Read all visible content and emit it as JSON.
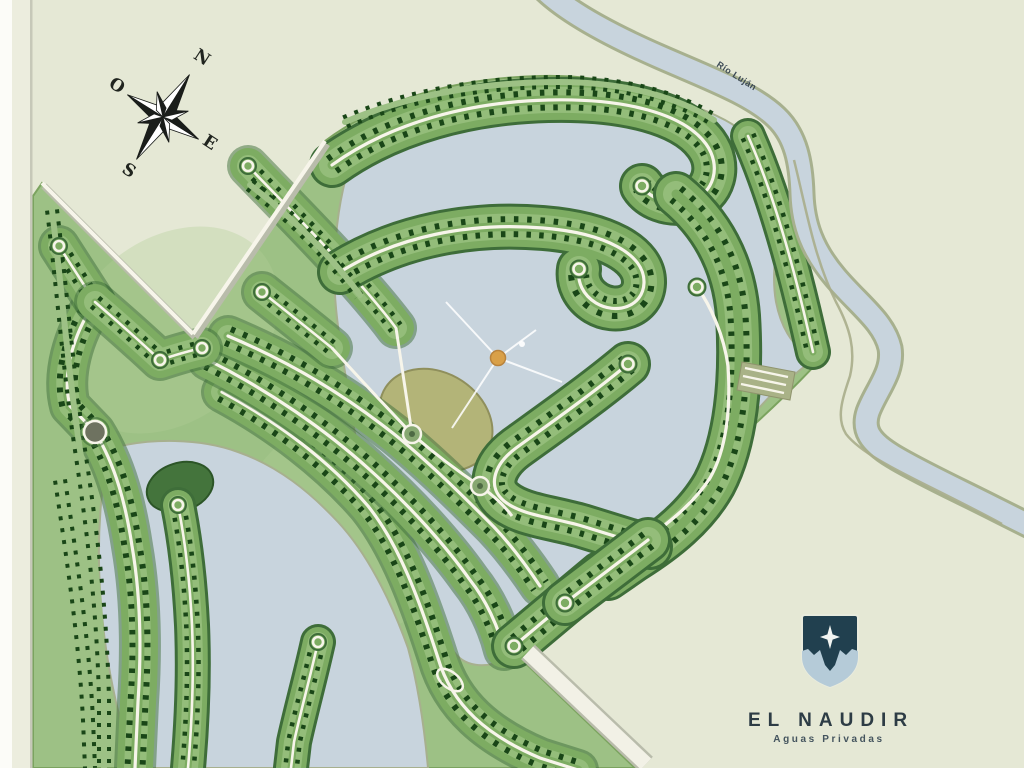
{
  "compass": {
    "n": "N",
    "o": "O",
    "e": "E",
    "s": "S"
  },
  "river": {
    "label": "Río Luján"
  },
  "logo": {
    "title": "EL NAUDIR",
    "subtitle": "Aguas Privadas"
  },
  "colors": {
    "land": "#e5e8d5",
    "marginWhite": "#fcfcf8",
    "marginBeige": "#ecedde",
    "marginLine": "#c6c8b8",
    "water": "#c8d4dd",
    "shore": "#a7b08e",
    "baseGreen": "#9dc185",
    "baseEdge": "#7ba35f",
    "bandEdge": "#3e6d39",
    "bandMain": "#7dac62",
    "bandLight": "#94bd7a",
    "lotDash": "#194617",
    "road": "#f7f5ea",
    "roadShadow": "#b9bcab",
    "khaki": "#b3b478",
    "khakiEdge": "#8f8f5c",
    "islandGreen": "#44743c",
    "fountain": "#d9a048",
    "compassInk": "#1a1d1a",
    "logoNavy": "#21404f",
    "logoBlue": "#b5cbd8",
    "logoStar": "#f2f5f2"
  }
}
